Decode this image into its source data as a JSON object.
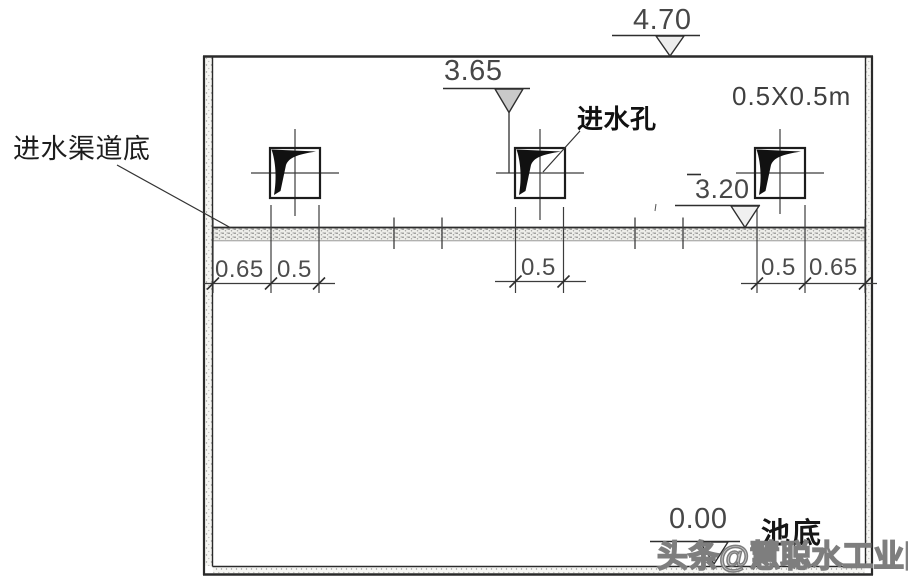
{
  "drawing": {
    "elevations": [
      "4.70",
      "3.65",
      "3.20",
      "0.00"
    ],
    "dimensions": {
      "left": [
        "0.65",
        "0.5"
      ],
      "middle": [
        "0.5"
      ],
      "right": [
        "0.5",
        "0.65"
      ]
    },
    "labels": {
      "channel_bottom": "进水渠道底",
      "inlet_hole": "进水孔",
      "pool_bottom": "池底",
      "hole_size": "0.5X0.5m"
    },
    "watermark": "头条@慧聪水工业网",
    "colors": {
      "line": "#2b2b2b",
      "thin_line": "#3c3c3c",
      "text": "#474747",
      "wedge_fill": "#111111",
      "triangle_gray": "#c9c9c9",
      "watermark": "#7e7e7e"
    }
  }
}
